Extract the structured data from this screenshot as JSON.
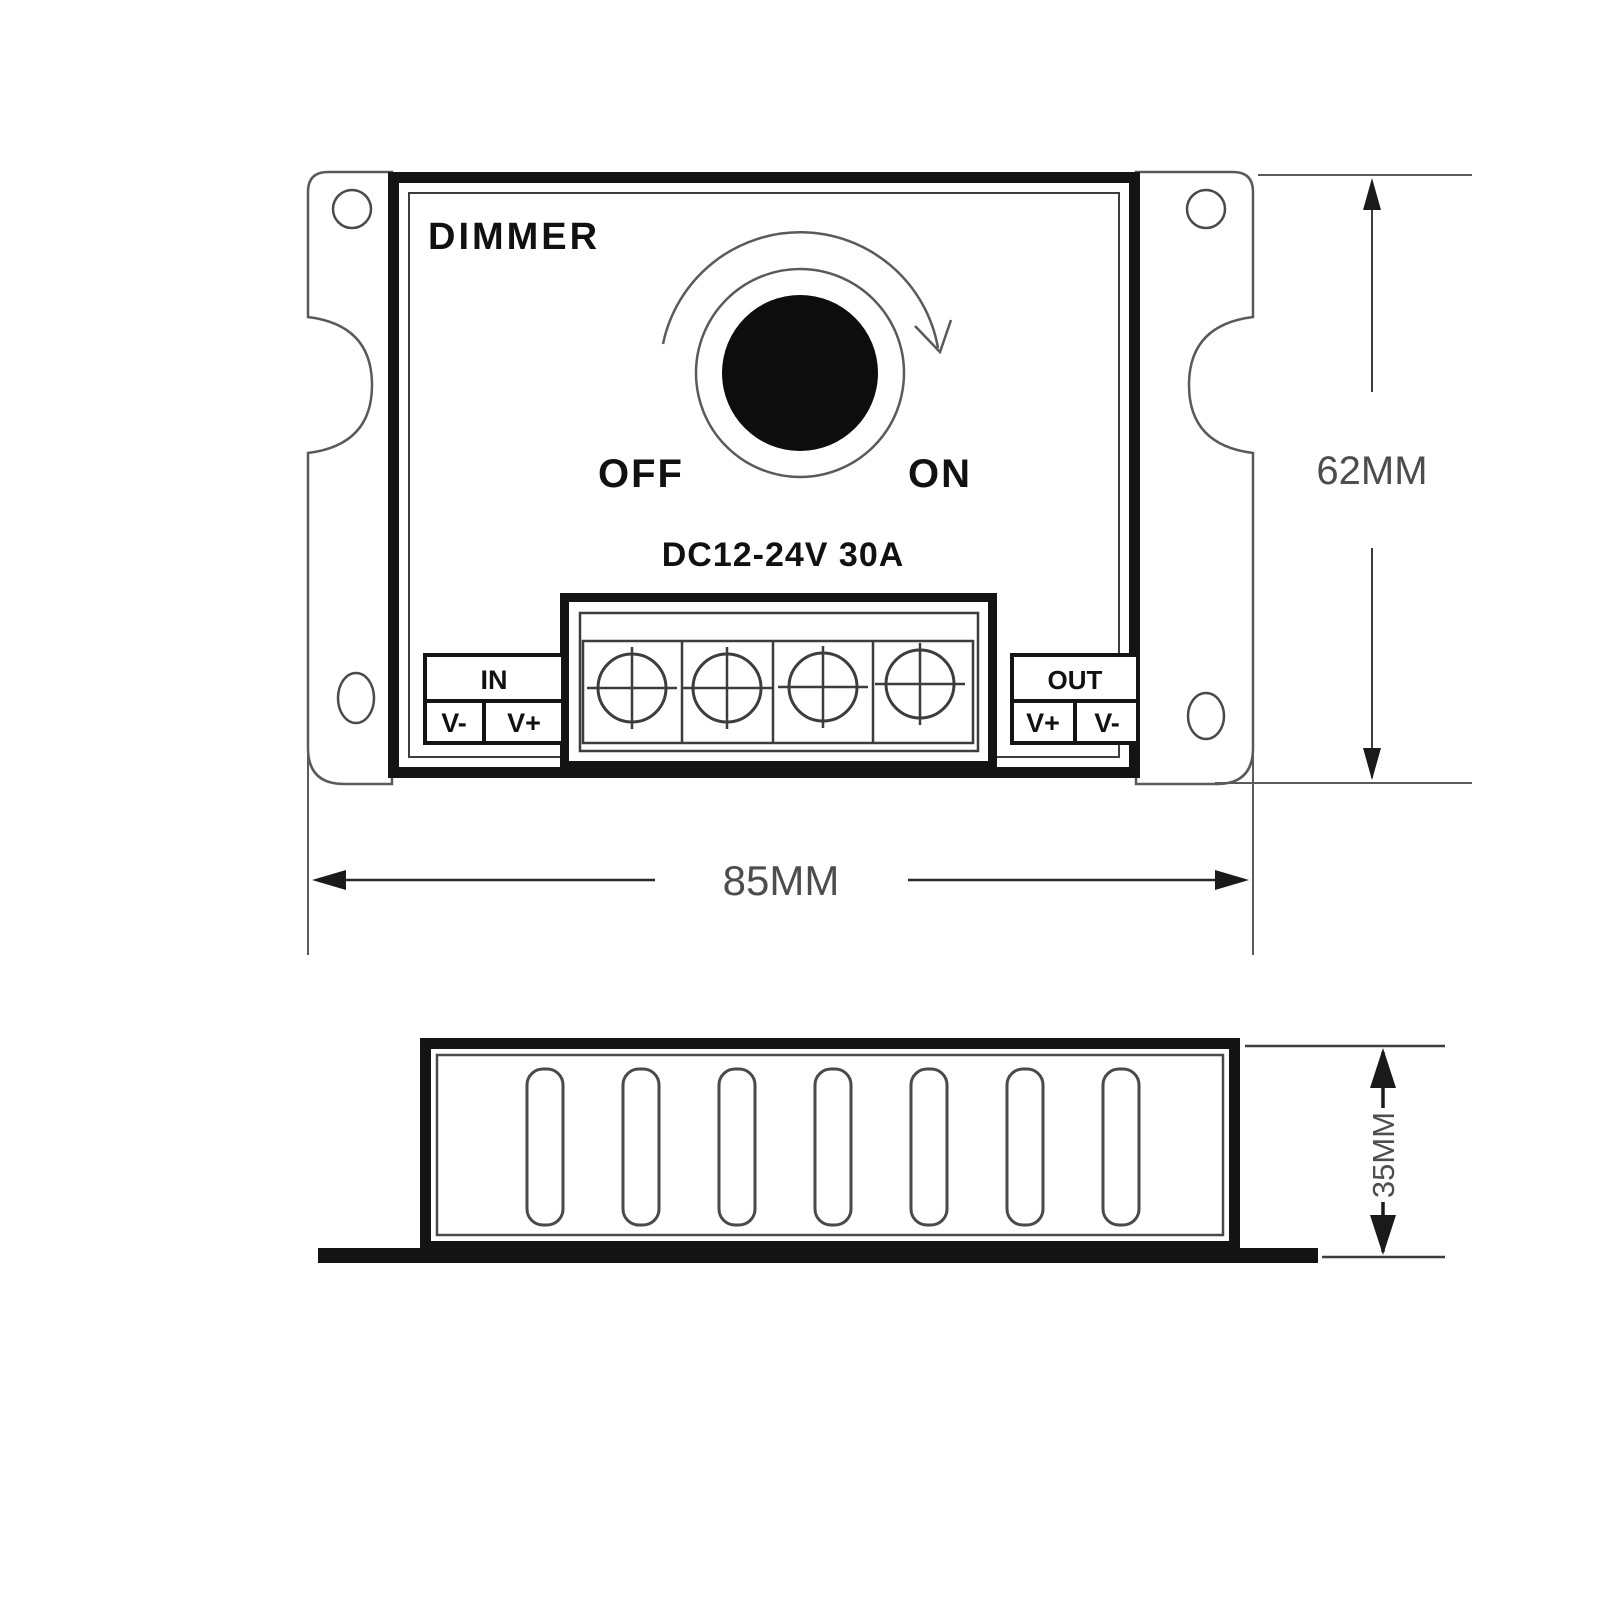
{
  "drawing": {
    "title": "DIMMER",
    "knob_off_label": "OFF",
    "knob_on_label": "ON",
    "rating": "DC12-24V 30A",
    "input_block": {
      "label": "IN",
      "pin_left": "V-",
      "pin_right": "V+"
    },
    "output_block": {
      "label": "OUT",
      "pin_left": "V+",
      "pin_right": "V-"
    },
    "dimensions": {
      "height": "62MM",
      "width": "85MM",
      "depth": "35MM"
    },
    "screw_terminal_count": 4,
    "vent_slot_count": 7
  },
  "colors": {
    "outline_dark": "#141414",
    "outline_mid": "#3d3d3d",
    "outline_light": "#5a5a5a",
    "dim_text": "#4d4d4d",
    "fill_white": "#ffffff",
    "knob_fill": "#0d0d0d"
  }
}
